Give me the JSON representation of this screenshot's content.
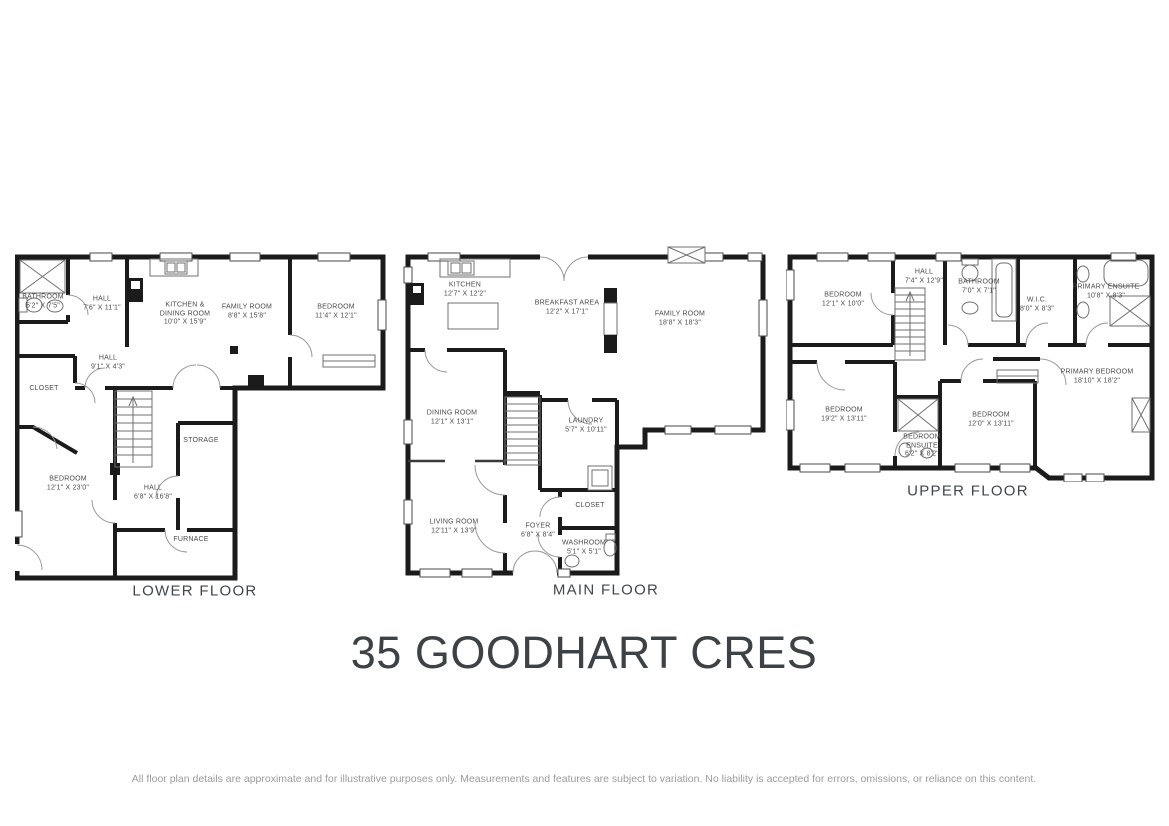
{
  "title": "35 GOODHART CRES",
  "disclaimer": "All floor plan details are approximate and for illustrative purposes only. Measurements and features are subject to variation. No liability is accepted for errors, omissions, or reliance on this content.",
  "colors": {
    "walls": "#1b1b1b",
    "room_labels": "#4b4b4b",
    "title_text": "#3d4247",
    "disclaimer_text": "#9c9c9c"
  },
  "floors": [
    {
      "label": "LOWER FLOOR",
      "rooms": [
        {
          "name": "BATHROOM",
          "dims": "5'2\" X 7'5\""
        },
        {
          "name": "HALL",
          "dims": "7'6\" X 11'1\""
        },
        {
          "name": "KITCHEN & DINING ROOM",
          "dims": "10'0\" X 15'9\""
        },
        {
          "name": "FAMILY ROOM",
          "dims": "8'8\" X 15'8\""
        },
        {
          "name": "BEDROOM",
          "dims": "11'4\" X 12'1\""
        },
        {
          "name": "HALL",
          "dims": "9'1\" X 4'3\""
        },
        {
          "name": "CLOSET",
          "dims": ""
        },
        {
          "name": "BEDROOM",
          "dims": "12'1\" X 23'0\""
        },
        {
          "name": "HALL",
          "dims": "6'8\" X 16'8\""
        },
        {
          "name": "STORAGE",
          "dims": ""
        },
        {
          "name": "FURNACE",
          "dims": ""
        }
      ]
    },
    {
      "label": "MAIN FLOOR",
      "rooms": [
        {
          "name": "KITCHEN",
          "dims": "12'7\" X 12'2\""
        },
        {
          "name": "BREAKFAST AREA",
          "dims": "12'2\" X 17'1\""
        },
        {
          "name": "FAMILY ROOM",
          "dims": "18'8\" X 18'3\""
        },
        {
          "name": "DINING ROOM",
          "dims": "12'1\" X 13'1\""
        },
        {
          "name": "LAUNDRY",
          "dims": "5'7\" X 10'11\""
        },
        {
          "name": "LIVING ROOM",
          "dims": "12'11\" X 13'9\""
        },
        {
          "name": "FOYER",
          "dims": "6'8\" X 8'4\""
        },
        {
          "name": "CLOSET",
          "dims": ""
        },
        {
          "name": "WASHROOM",
          "dims": "5'1\" X 5'1\""
        }
      ]
    },
    {
      "label": "UPPER FLOOR",
      "rooms": [
        {
          "name": "BEDROOM",
          "dims": "12'1\" X 10'0\""
        },
        {
          "name": "HALL",
          "dims": "7'4\" X 12'9\""
        },
        {
          "name": "BATHROOM",
          "dims": "7'0\" X 7'1\""
        },
        {
          "name": "W.I.C.",
          "dims": "8'0\" X 8'3\""
        },
        {
          "name": "PRIMARY ENSUITE",
          "dims": "10'8\" X 8'3\""
        },
        {
          "name": "BEDROOM",
          "dims": "19'2\" X 13'11\""
        },
        {
          "name": "BEDROOM ENSUITE",
          "dims": "6'2\" X 8'2\""
        },
        {
          "name": "BEDROOM",
          "dims": "12'0\" X 13'11\""
        },
        {
          "name": "PRIMARY BEDROOM",
          "dims": "18'10\" X 18'2\""
        }
      ]
    }
  ]
}
